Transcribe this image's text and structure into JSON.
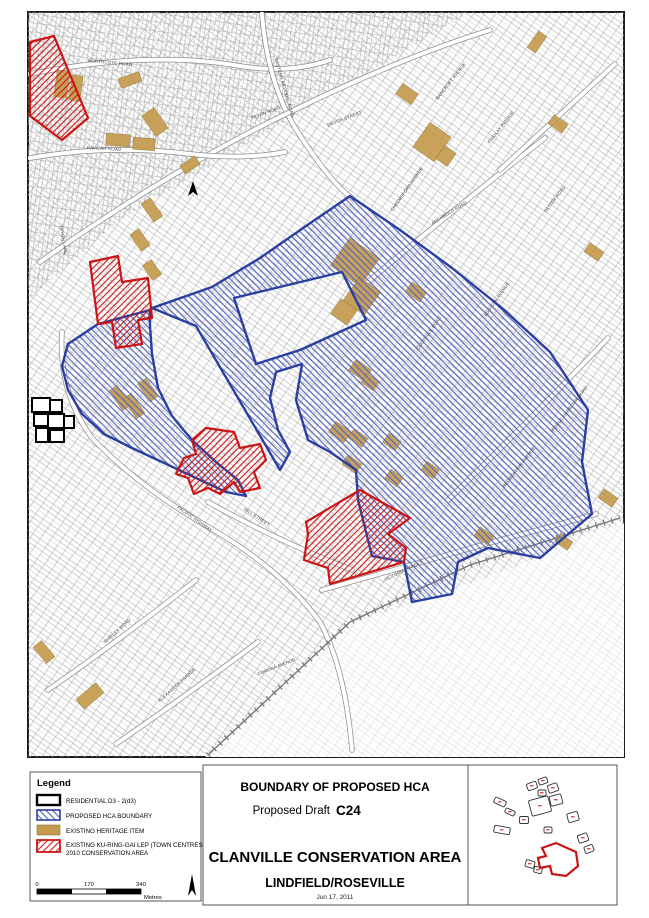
{
  "title_block": {
    "line1": "BOUNDARY OF PROPOSED HCA",
    "line2_prefix": "Proposed Draft",
    "line2_code": "C24",
    "line3": "CLANVILLE CONSERVATION AREA",
    "line4": "LINDFIELD/ROSEVILLE",
    "date": "Jun 17, 2011"
  },
  "legend": {
    "title": "Legend",
    "items": [
      {
        "label": "RESIDENTIAL D3 - 2(d3)",
        "swatch": "residential"
      },
      {
        "label": "PROPOSED HCA BOUNDARY",
        "swatch": "hca"
      },
      {
        "label": "EXISTING HERITAGE ITEM",
        "swatch": "heritage"
      },
      {
        "label": "EXISTING KU-RING-GAI LEP (TOWN CENTRES)",
        "label_line2": "2010 CONSERVATION AREA",
        "swatch": "lep"
      }
    ]
  },
  "scale_bar": {
    "labels": [
      "0",
      "170",
      "340"
    ],
    "unit": "Metres"
  },
  "colors": {
    "hca_blue": "#2b3fa0",
    "hca_hatch": "#5465bd",
    "lep_red": "#cc1414",
    "heritage_tan": "#c49a4e",
    "parcel_grey": "#a8a8a8",
    "parcel_faded": "#d9d9d9"
  },
  "map": {
    "street_labels": [
      {
        "name": "NORTHCOTE ROAD",
        "x": 110,
        "y": 64,
        "rot": 5
      },
      {
        "name": "EASTERN ARTERIAL ROAD",
        "x": 283,
        "y": 88,
        "rot": 74
      },
      {
        "name": "TRYON ROAD",
        "x": 266,
        "y": 114,
        "rot": -21
      },
      {
        "name": "DEVON STREET",
        "x": 345,
        "y": 120,
        "rot": -21
      },
      {
        "name": "HAVILAH ROAD",
        "x": 104,
        "y": 150,
        "rot": 3
      },
      {
        "name": "TRYON LANE",
        "x": 62,
        "y": 240,
        "rot": 80
      },
      {
        "name": "BANCROFT AVENUE",
        "x": 452,
        "y": 82,
        "rot": -52
      },
      {
        "name": "FINDLAY AVENUE",
        "x": 502,
        "y": 128,
        "rot": -52
      },
      {
        "name": "OLIVER ROAD",
        "x": 556,
        "y": 200,
        "rot": -52
      },
      {
        "name": "CHELMSFORD AVENUE",
        "x": 408,
        "y": 190,
        "rot": -55
      },
      {
        "name": "ARCHBOLD ROAD",
        "x": 450,
        "y": 214,
        "rot": -32
      },
      {
        "name": "CLANVILLE ROAD",
        "x": 430,
        "y": 334,
        "rot": -55
      },
      {
        "name": "ADDISON AVENUE",
        "x": 498,
        "y": 300,
        "rot": -55
      },
      {
        "name": "MIDDLE HARBOUR ROAD",
        "x": 570,
        "y": 410,
        "rot": -52
      },
      {
        "name": "RECREATION AVENUE",
        "x": 520,
        "y": 468,
        "rot": -52
      },
      {
        "name": "HILL STREET",
        "x": 256,
        "y": 518,
        "rot": 33
      },
      {
        "name": "PACIFIC HIGHWAY",
        "x": 194,
        "y": 520,
        "rot": 35
      },
      {
        "name": "VICTORIA STREET",
        "x": 404,
        "y": 572,
        "rot": -26
      },
      {
        "name": "SHIRLEY ROAD",
        "x": 118,
        "y": 632,
        "rot": -42
      },
      {
        "name": "ALEXANDER PARADE",
        "x": 178,
        "y": 686,
        "rot": -42
      },
      {
        "name": "CORONA AVENUE",
        "x": 277,
        "y": 668,
        "rot": -22
      }
    ],
    "roads": [
      {
        "d": "M30,74 Q150,50 240,66 Q290,74 330,60"
      },
      {
        "d": "M262,14 Q268,90 303,140 Q333,185 352,198"
      },
      {
        "d": "M40,262 Q170,170 290,112 Q400,58 490,30"
      },
      {
        "d": "M30,158 Q110,144 190,154 Q245,160 285,152"
      },
      {
        "d": "M62,332 Q58,392 92,438 Q140,488 210,528 Q280,568 320,622 Q345,668 352,750"
      },
      {
        "d": "M208,502 Q280,542 352,570"
      },
      {
        "d": "M322,590 Q430,560 500,540 Q550,527 596,514"
      },
      {
        "d": "M48,690 Q120,640 196,580"
      },
      {
        "d": "M116,744 Q180,700 258,642"
      },
      {
        "d": "M356,292 Q450,212 545,138"
      },
      {
        "d": "M448,500 Q530,420 608,338"
      },
      {
        "d": "M500,170 Q560,115 615,64"
      }
    ],
    "railway": {
      "d": "M208,755 L350,622 L470,565 L620,518"
    },
    "fade_region": {
      "d": "M205,757 L345,625 L430,598 L520,565 L600,530 L642,518 L642,757 Z"
    },
    "grid_region_nw": {
      "d": "M28,12 L470,12 L120,220 L28,300 Z"
    },
    "boundaries": [
      {
        "name": "hca-boundary-main",
        "cls": "hca",
        "d": "M152,308 L212,287 L260,258 L306,226 L350,196 L400,230 L452,268 L502,308 L550,352 L588,410 L582,462 L592,514 L540,558 L488,548 L458,562 L452,594 L412,602 L404,562 L372,556 L358,500 L356,470 L330,452 L308,440 L296,400 L302,364 L276,372 L270,398 L278,430 L290,452 L280,470 L196,326 Z M234,298 L342,272 L366,320 L300,350 L256,364 Z"
      },
      {
        "name": "hca-boundary-arm",
        "cls": "hca",
        "d": "M98,324 L150,310 L150,326 L152,354 L158,388 L172,416 L192,440 L216,462 L238,480 L246,496 L226,492 L196,478 L162,462 L132,448 L104,434 L82,414 L68,390 L62,366 L68,344 Z"
      },
      {
        "name": "lep-area-north",
        "cls": "lep",
        "d": "M90,262 L118,256 L122,282 L148,278 L152,318 L138,320 L142,344 L116,348 L112,322 L98,324 Z"
      },
      {
        "name": "lep-area-centre",
        "cls": "lep",
        "d": "M206,428 L234,432 L240,448 L260,444 L266,460 L254,472 L260,488 L240,492 L234,482 L220,494 L208,488 L194,494 L188,478 L176,474 L184,458 L196,454 L192,440 Z"
      },
      {
        "name": "lep-area-south",
        "cls": "lep",
        "d": "M306,522 L360,490 L410,518 L388,534 L406,548 L404,562 L330,584 L328,568 L304,560 L308,534 Z"
      },
      {
        "name": "lep-area-west-edge",
        "cls": "lep",
        "d": "M30,42 L54,36 L88,118 L62,140 L30,116 Z"
      }
    ],
    "d3_parcels": [
      [
        32,
        398,
        18,
        14
      ],
      [
        50,
        400,
        12,
        12
      ],
      [
        34,
        414,
        14,
        12
      ],
      [
        48,
        414,
        16,
        14
      ],
      [
        36,
        428,
        12,
        14
      ],
      [
        50,
        430,
        14,
        12
      ],
      [
        64,
        416,
        10,
        12
      ]
    ],
    "north_mark": {
      "d": "M193,181 L198,196 L193,192 L188,196 Z"
    },
    "heritage_items": [
      [
        62,
        84,
        13,
        27,
        8
      ],
      [
        76,
        88,
        11,
        25,
        8
      ],
      [
        130,
        80,
        22,
        10,
        -20
      ],
      [
        155,
        122,
        15,
        25,
        -35
      ],
      [
        118,
        140,
        24,
        12,
        4
      ],
      [
        144,
        144,
        22,
        12,
        4
      ],
      [
        190,
        165,
        18,
        10,
        -35
      ],
      [
        152,
        210,
        11,
        22,
        -35
      ],
      [
        140,
        240,
        11,
        20,
        -35
      ],
      [
        152,
        270,
        11,
        18,
        -35
      ],
      [
        537,
        42,
        20,
        10,
        -55
      ],
      [
        407,
        94,
        13,
        19,
        -55
      ],
      [
        432,
        142,
        30,
        26,
        -55
      ],
      [
        446,
        156,
        16,
        14,
        -55
      ],
      [
        558,
        124,
        11,
        17,
        -55
      ],
      [
        594,
        252,
        11,
        17,
        -55
      ],
      [
        355,
        262,
        34,
        36,
        -55
      ],
      [
        362,
        296,
        28,
        26,
        -55
      ],
      [
        344,
        312,
        18,
        20,
        -55
      ],
      [
        416,
        292,
        12,
        18,
        -55
      ],
      [
        360,
        370,
        13,
        19,
        -55
      ],
      [
        370,
        382,
        11,
        15,
        -55
      ],
      [
        120,
        398,
        10,
        24,
        -35
      ],
      [
        134,
        406,
        10,
        24,
        -35
      ],
      [
        148,
        390,
        10,
        22,
        -35
      ],
      [
        340,
        432,
        13,
        19,
        -55
      ],
      [
        358,
        438,
        11,
        17,
        -55
      ],
      [
        392,
        442,
        11,
        15,
        -55
      ],
      [
        352,
        464,
        11,
        17,
        -55
      ],
      [
        394,
        478,
        11,
        15,
        -55
      ],
      [
        430,
        470,
        11,
        15,
        -55
      ],
      [
        484,
        536,
        11,
        17,
        -55
      ],
      [
        564,
        542,
        10,
        15,
        -55
      ],
      [
        608,
        498,
        11,
        17,
        -55
      ],
      [
        44,
        652,
        11,
        21,
        -40
      ],
      [
        90,
        696,
        26,
        13,
        -40
      ]
    ],
    "inset": {
      "blobs": [
        [
          532,
          786,
          10,
          7,
          -20
        ],
        [
          543,
          781,
          9,
          6,
          -20
        ],
        [
          553,
          788,
          10,
          8,
          -20
        ],
        [
          542,
          793,
          8,
          6,
          0
        ],
        [
          500,
          802,
          12,
          6,
          25
        ],
        [
          510,
          812,
          10,
          5,
          25
        ],
        [
          540,
          806,
          20,
          16,
          -15
        ],
        [
          556,
          800,
          12,
          10,
          -15
        ],
        [
          524,
          820,
          9,
          7,
          0
        ],
        [
          502,
          830,
          16,
          7,
          10
        ],
        [
          573,
          817,
          11,
          9,
          -15
        ],
        [
          548,
          830,
          8,
          6,
          0
        ],
        [
          583,
          838,
          10,
          8,
          -20
        ],
        [
          589,
          849,
          9,
          7,
          -20
        ],
        [
          530,
          864,
          9,
          7,
          15
        ],
        [
          538,
          870,
          8,
          6,
          15
        ]
      ],
      "highlight": {
        "d": "M542,848 L556,843 L576,852 L578,866 L566,876 L552,874 L550,866 L540,868 L538,858 L546,856 Z"
      }
    }
  }
}
